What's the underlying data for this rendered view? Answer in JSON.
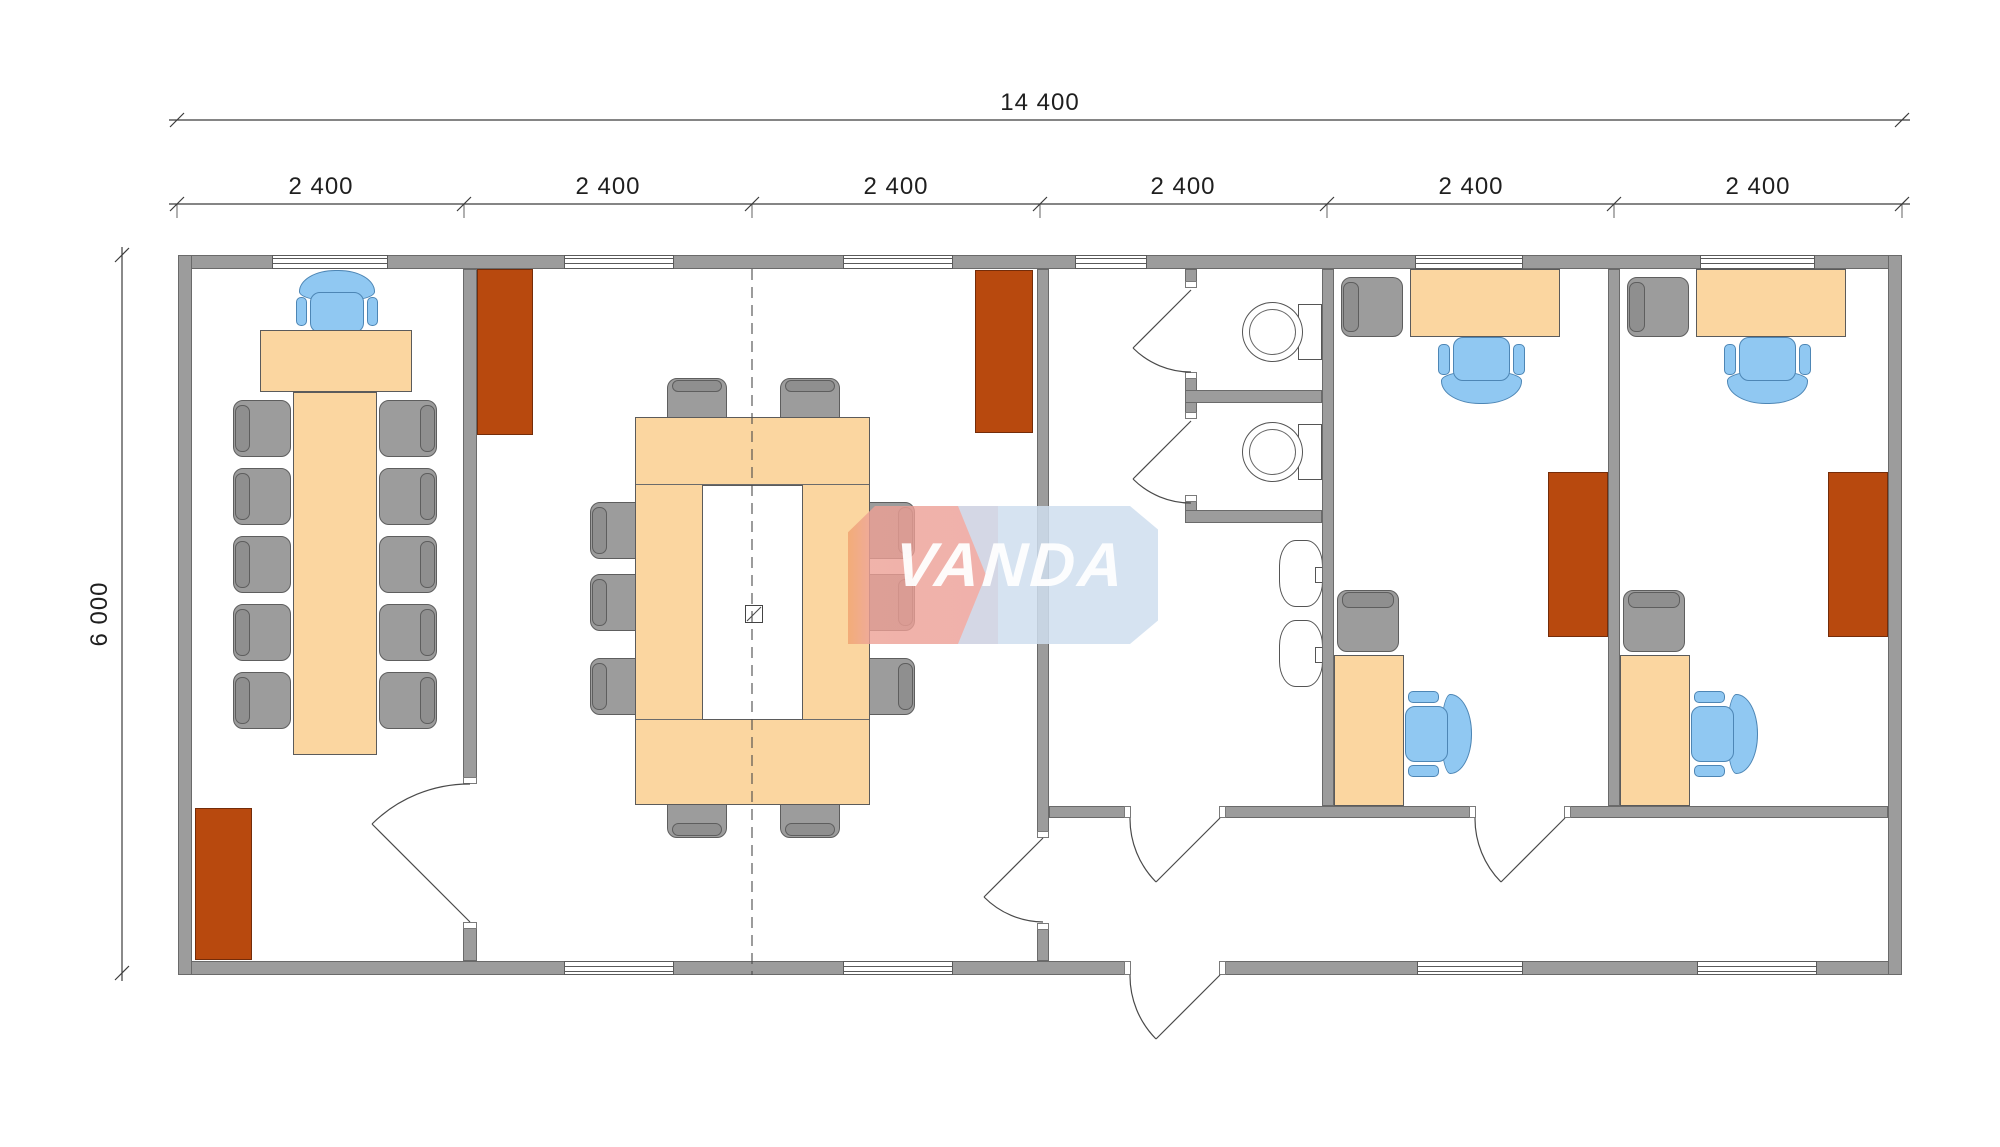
{
  "dimensions": {
    "total_width": "14 400",
    "modules": [
      "2 400",
      "2 400",
      "2 400",
      "2 400",
      "2 400",
      "2 400"
    ],
    "height": "6 000"
  },
  "watermark": {
    "text": "VANDA"
  },
  "colors": {
    "wall": "#9c9c9c",
    "wall_edge": "#6a6a6a",
    "furniture_orange": "#fbd6a0",
    "cabinet_brown": "#b8490e",
    "chair_gray": "#9c9c9c",
    "chair_blue": "#90c8f2",
    "watermark_pink": "#ec9d96",
    "watermark_blue": "#cfdeee",
    "line": "#4a4a4a"
  },
  "plan": {
    "furniture": [
      {
        "type": "bluechair",
        "x": 296,
        "y": 270,
        "w": 82,
        "h": 64,
        "o": "down"
      },
      {
        "type": "desk",
        "x": 260,
        "y": 330,
        "w": 152,
        "h": 62
      },
      {
        "type": "desk",
        "x": 293,
        "y": 392,
        "w": 84,
        "h": 363
      },
      {
        "type": "gchair",
        "x": 233,
        "y": 400,
        "w": 58,
        "h": 57,
        "o": "w"
      },
      {
        "type": "gchair",
        "x": 233,
        "y": 468,
        "w": 58,
        "h": 57,
        "o": "w"
      },
      {
        "type": "gchair",
        "x": 233,
        "y": 536,
        "w": 58,
        "h": 57,
        "o": "w"
      },
      {
        "type": "gchair",
        "x": 233,
        "y": 604,
        "w": 58,
        "h": 57,
        "o": "w"
      },
      {
        "type": "gchair",
        "x": 233,
        "y": 672,
        "w": 58,
        "h": 57,
        "o": "w"
      },
      {
        "type": "gchair",
        "x": 379,
        "y": 400,
        "w": 58,
        "h": 57,
        "o": "e"
      },
      {
        "type": "gchair",
        "x": 379,
        "y": 468,
        "w": 58,
        "h": 57,
        "o": "e"
      },
      {
        "type": "gchair",
        "x": 379,
        "y": 536,
        "w": 58,
        "h": 57,
        "o": "e"
      },
      {
        "type": "gchair",
        "x": 379,
        "y": 604,
        "w": 58,
        "h": 57,
        "o": "e"
      },
      {
        "type": "gchair",
        "x": 379,
        "y": 672,
        "w": 58,
        "h": 57,
        "o": "e"
      },
      {
        "type": "cabinet",
        "x": 195,
        "y": 808,
        "w": 57,
        "h": 152
      },
      {
        "type": "cabinet",
        "x": 477,
        "y": 269,
        "w": 56,
        "h": 166
      },
      {
        "type": "cabinet",
        "x": 975,
        "y": 270,
        "w": 58,
        "h": 163
      },
      {
        "type": "gchair",
        "x": 667,
        "y": 378,
        "w": 60,
        "h": 50,
        "o": "n"
      },
      {
        "type": "gchair",
        "x": 780,
        "y": 378,
        "w": 60,
        "h": 50,
        "o": "n"
      },
      {
        "type": "gchair",
        "x": 667,
        "y": 786,
        "w": 60,
        "h": 52,
        "o": "s"
      },
      {
        "type": "gchair",
        "x": 780,
        "y": 786,
        "w": 60,
        "h": 52,
        "o": "s"
      },
      {
        "type": "gchair",
        "x": 590,
        "y": 502,
        "w": 58,
        "h": 57,
        "o": "w"
      },
      {
        "type": "gchair",
        "x": 590,
        "y": 574,
        "w": 58,
        "h": 57,
        "o": "w"
      },
      {
        "type": "gchair",
        "x": 590,
        "y": 658,
        "w": 58,
        "h": 57,
        "o": "w"
      },
      {
        "type": "gchair",
        "x": 857,
        "y": 502,
        "w": 58,
        "h": 57,
        "o": "e"
      },
      {
        "type": "gchair",
        "x": 857,
        "y": 574,
        "w": 58,
        "h": 57,
        "o": "e"
      },
      {
        "type": "gchair",
        "x": 857,
        "y": 658,
        "w": 58,
        "h": 57,
        "o": "e"
      },
      {
        "type": "toilet",
        "x": 1242,
        "y": 302,
        "w": 80,
        "h": 60
      },
      {
        "type": "toilet",
        "x": 1242,
        "y": 422,
        "w": 80,
        "h": 60
      },
      {
        "type": "sink",
        "x": 1279,
        "y": 540,
        "w": 44,
        "h": 67
      },
      {
        "type": "sink",
        "x": 1279,
        "y": 620,
        "w": 44,
        "h": 67
      },
      {
        "type": "desk",
        "x": 1410,
        "y": 269,
        "w": 150,
        "h": 68
      },
      {
        "type": "gchair",
        "x": 1341,
        "y": 277,
        "w": 62,
        "h": 60,
        "o": "w"
      },
      {
        "type": "bluechair",
        "x": 1438,
        "y": 336,
        "w": 87,
        "h": 68,
        "o": "up"
      },
      {
        "type": "cabinet",
        "x": 1548,
        "y": 472,
        "w": 60,
        "h": 165
      },
      {
        "type": "desk",
        "x": 1334,
        "y": 655,
        "w": 70,
        "h": 151
      },
      {
        "type": "gchair",
        "x": 1337,
        "y": 590,
        "w": 62,
        "h": 62,
        "o": "n"
      },
      {
        "type": "bluechair",
        "x": 1404,
        "y": 691,
        "w": 68,
        "h": 86,
        "o": "left"
      },
      {
        "type": "desk",
        "x": 1696,
        "y": 269,
        "w": 150,
        "h": 68
      },
      {
        "type": "gchair",
        "x": 1627,
        "y": 277,
        "w": 62,
        "h": 60,
        "o": "w"
      },
      {
        "type": "bluechair",
        "x": 1724,
        "y": 336,
        "w": 87,
        "h": 68,
        "o": "up"
      },
      {
        "type": "cabinet",
        "x": 1828,
        "y": 472,
        "w": 60,
        "h": 165
      },
      {
        "type": "desk",
        "x": 1620,
        "y": 655,
        "w": 70,
        "h": 151
      },
      {
        "type": "gchair",
        "x": 1623,
        "y": 590,
        "w": 62,
        "h": 62,
        "o": "n"
      },
      {
        "type": "bluechair",
        "x": 1690,
        "y": 691,
        "w": 68,
        "h": 86,
        "o": "left"
      }
    ]
  }
}
